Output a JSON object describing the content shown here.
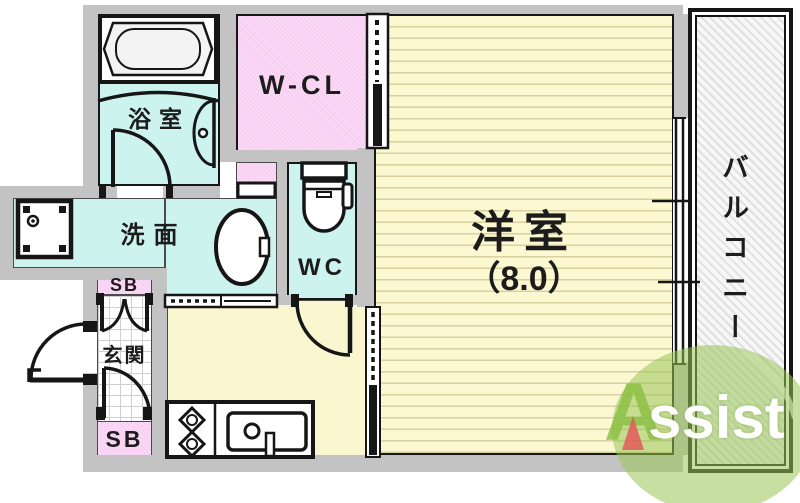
{
  "floorplan": {
    "rooms": {
      "bathroom": {
        "label": "浴室"
      },
      "walk_in_closet": {
        "label": "W-CL"
      },
      "washroom": {
        "label": "洗面"
      },
      "toilet": {
        "label": "WC"
      },
      "western_room": {
        "label": "洋室",
        "size_label": "（8.0）"
      },
      "balcony": {
        "label": "バルコニー"
      },
      "entrance": {
        "label": "玄関"
      },
      "shoe_box_top": {
        "label": "SB"
      },
      "shoe_box_bottom": {
        "label": "SB"
      }
    },
    "logo": {
      "letter_a": "A",
      "letter_rest": "ssist"
    },
    "colors": {
      "wall_gray": "#c3c3c3",
      "room_cyan": "#cdf3ee",
      "room_pink": "#f8cff2",
      "room_yellow": "#faf6cf",
      "tatami_line": "#d9d1a0",
      "line_black": "#161616",
      "logo_green": "#9ac456",
      "logo_red": "#e25a5a"
    }
  }
}
